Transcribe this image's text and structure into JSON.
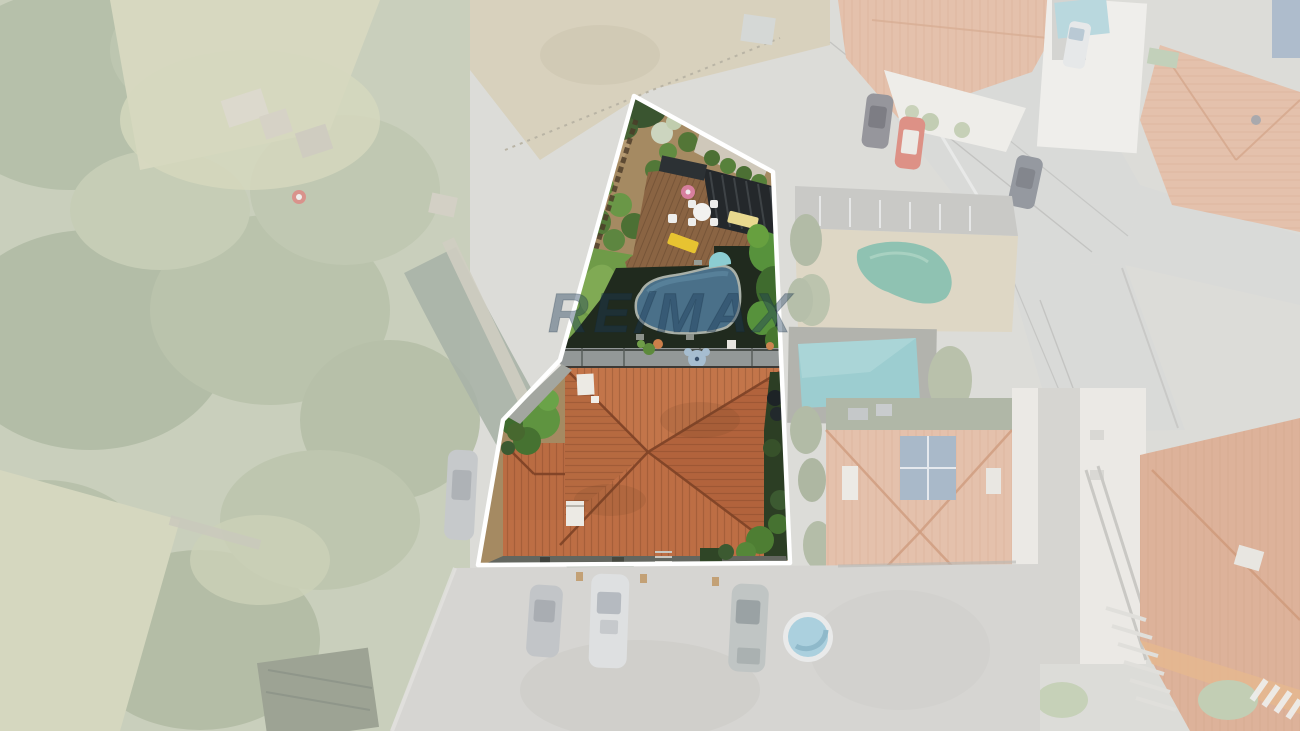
{
  "watermark": {
    "text": "RE/MAX",
    "color": "#1b3a57",
    "opacity": "0.40"
  },
  "scene": {
    "type": "aerial-drone-photograph",
    "subject": "residential parcel highlighted with white boundary; house with terracotta hip roof, lawn, kidney-shaped pool, wooden deck with pergola and yellow sun loungers; surrounding neighborhood faded white",
    "highlight_style": "white polygon outline, exterior washed out"
  },
  "colors": {
    "parcel_outline": "#ffffff",
    "garden_dirt": "#a58a62",
    "lawn": "#6f9b48",
    "lawn_light": "#88b15a",
    "deck_wood": "#8a6443",
    "pergola": "#24282b",
    "lounger_yellow": "#e7c331",
    "umbrella_pink": "#d77f9d",
    "shadow_dark": "#202a1e",
    "pool_water": "#4a7089",
    "pool_steps": "#8ccdd2",
    "hedge_green": "#57923c",
    "patio_gray": "#939898",
    "bear_motif": "#a6bdd0",
    "roof_top": "#c3754a",
    "roof_right": "#b2633c",
    "roof_bottom": "#bd6e44",
    "roof_left": "#b66a40",
    "roof_wing": "#ba6c42",
    "roof_ridge": "#7e4226",
    "chimney": "#eceae4",
    "faded_base": "#dcdcd8",
    "faded_veg": "#bcc4b0",
    "faded_field": "#d8d9c1",
    "faded_road": "#d9dad8",
    "faded_roof": "#e4c1ac",
    "neighbor_pool": "#9ccdd0",
    "tarp_teal": "#8fc2b2",
    "round_pool": "#abd0de",
    "red_car": "#dd9186"
  }
}
